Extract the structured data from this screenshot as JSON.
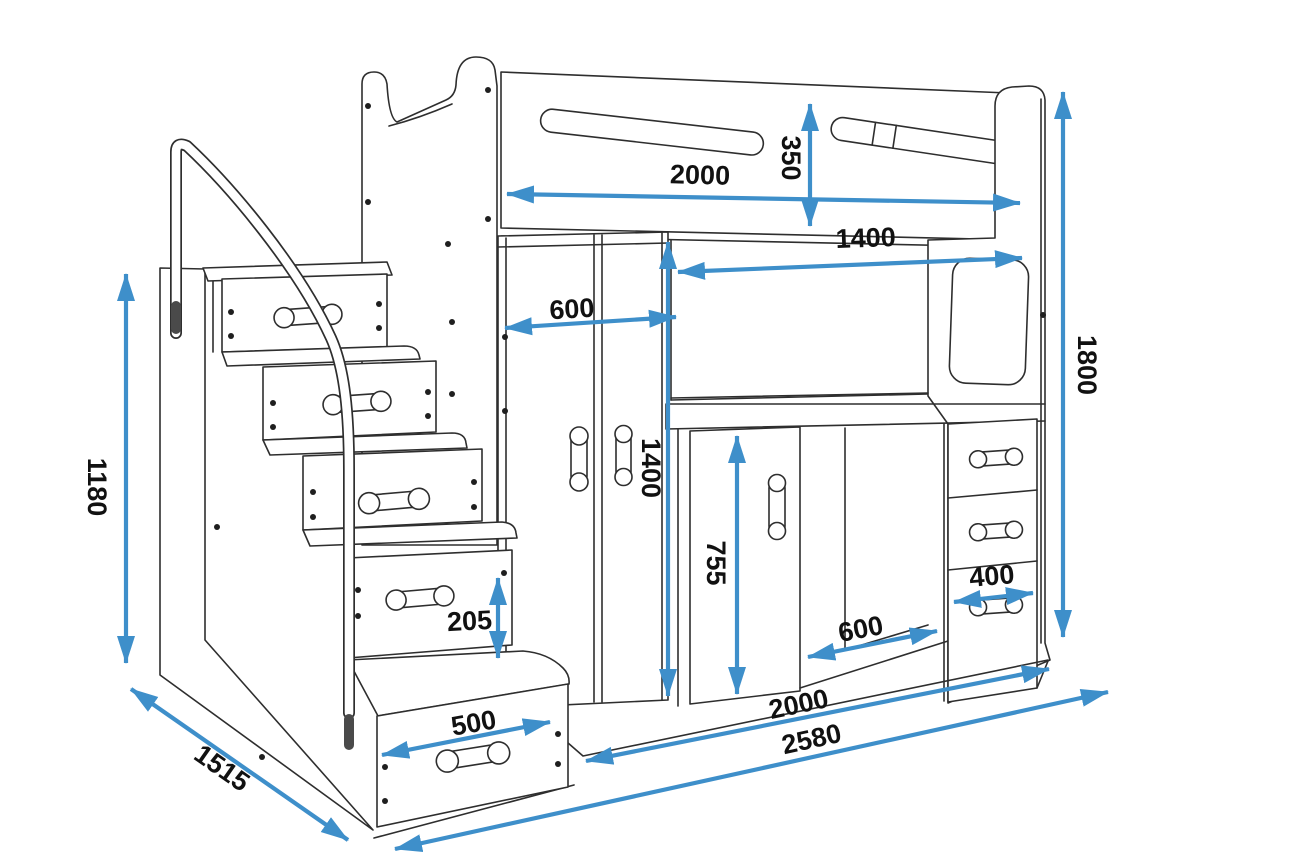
{
  "diagram": {
    "title": "loft-bed-technical-drawing",
    "subject": "Loft bed with drawer staircase, wardrobe, desk and drawer unit",
    "unit": "mm",
    "colors": {
      "line": "#2e2e2e",
      "dimension_arrow": "#3e8fca",
      "label_text": "#111111",
      "background": "#ffffff"
    },
    "dimensions": [
      {
        "id": "bed-length-top",
        "value": "2000"
      },
      {
        "id": "guardrail-height",
        "value": "350"
      },
      {
        "id": "desk-niche-width",
        "value": "1400"
      },
      {
        "id": "wardrobe-width",
        "value": "600"
      },
      {
        "id": "wardrobe-height",
        "value": "1400"
      },
      {
        "id": "total-height",
        "value": "1800"
      },
      {
        "id": "stairs-height",
        "value": "1180"
      },
      {
        "id": "step-rise",
        "value": "205"
      },
      {
        "id": "step-width",
        "value": "500"
      },
      {
        "id": "under-desk-clearance",
        "value": "755"
      },
      {
        "id": "drawer-unit-width",
        "value": "400"
      },
      {
        "id": "desk-depth",
        "value": "600"
      },
      {
        "id": "bed-base-length",
        "value": "2000"
      },
      {
        "id": "total-length",
        "value": "2580"
      },
      {
        "id": "total-depth",
        "value": "1515"
      }
    ]
  }
}
